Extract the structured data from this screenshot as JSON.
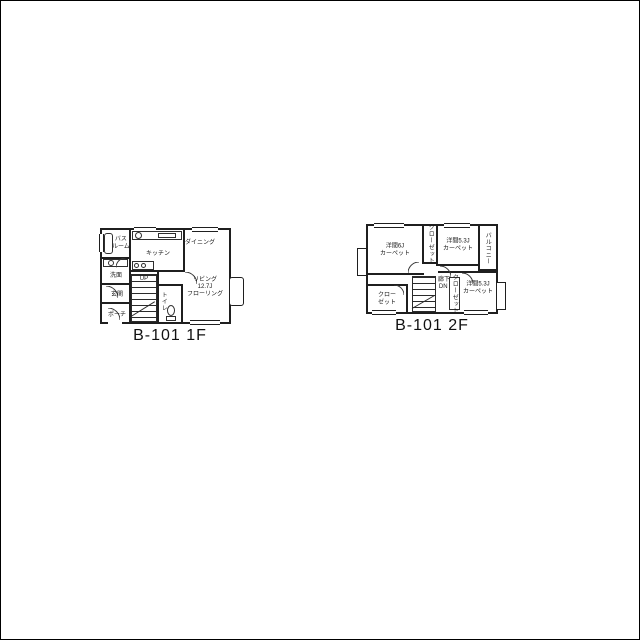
{
  "page": {
    "background": "#ffffff",
    "line_color": "#1f1f1f",
    "frame_color": "#000000"
  },
  "floor1": {
    "caption": "B-101 1F",
    "labels": {
      "bath_l1": "バス",
      "bath_l2": "ルーム",
      "wash": "洗面",
      "kitchen": "キッチン",
      "dining": "ダイニング",
      "living_l1": "リビング",
      "living_l2": "12.7J",
      "living_l3": "フローリング",
      "entrance": "玄関",
      "porch": "ポーチ",
      "toilet": "トイレ",
      "stairs_dir": "UP"
    }
  },
  "floor2": {
    "caption": "B-101 2F",
    "labels": {
      "room_nw_l1": "洋間6J",
      "room_nw_l2": "カーペット",
      "room_ne_l1": "洋間5.3J",
      "room_ne_l2": "カーペット",
      "room_se_l1": "洋間5.3J",
      "room_se_l2": "カーペット",
      "balcony": "バルコニー",
      "closet_top": "クローゼット",
      "closet_mid": "クローゼット",
      "closet_sw_l1": "クロー",
      "closet_sw_l2": "ゼット",
      "hall": "廊下",
      "stairs_dir": "DN"
    }
  }
}
